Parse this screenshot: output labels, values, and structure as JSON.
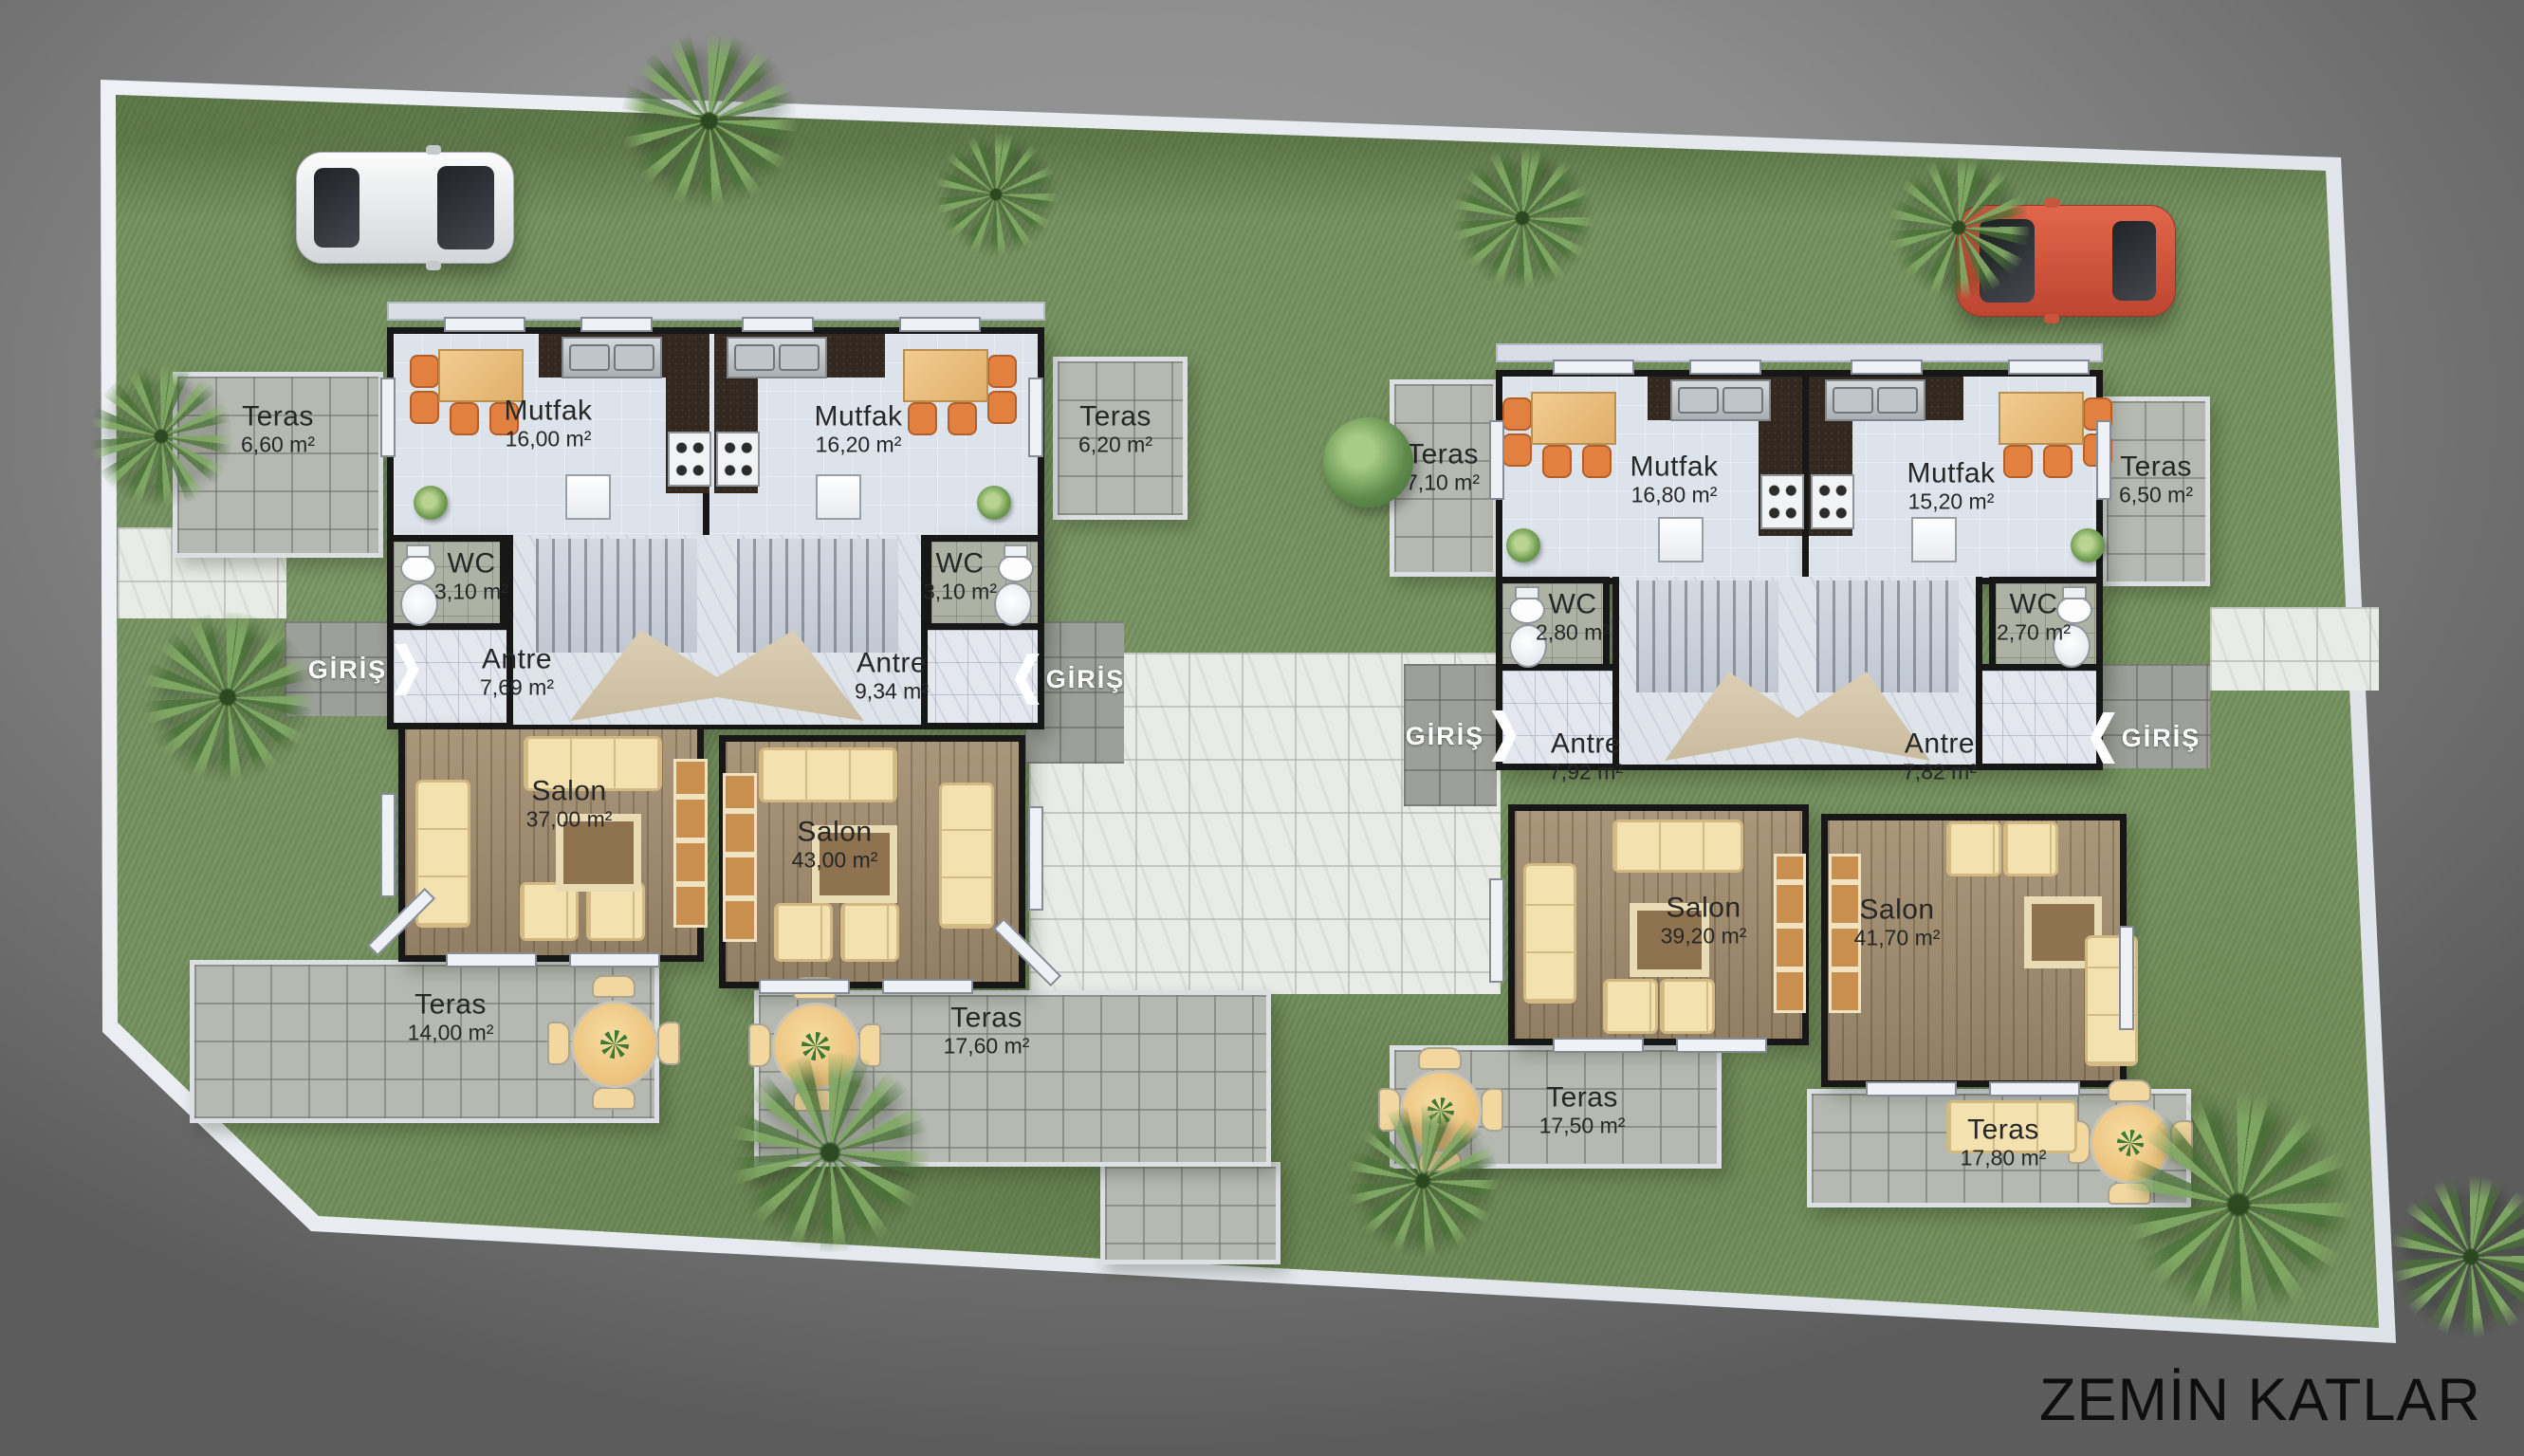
{
  "title": "ZEMİN KATLAR",
  "giris_label": "GİRİŞ",
  "colors": {
    "background_gray": "#8d8d8d",
    "grass": "#74905d",
    "site_border": "#e7eaef",
    "wall": "#171717",
    "terrace_tile": "#b6b9b2",
    "plaza_tile": "#e9ece6",
    "kitchen_floor": "#dde3eb",
    "salon_wood": "#a38e6f",
    "sofa_cream": "#f3e2b0",
    "chair_orange": "#e2813f",
    "car_white": "#f0f0f0",
    "car_red": "#d05540",
    "title_color": "#0e0e0e"
  },
  "b0": {
    "u0": {
      "teras_top": {
        "name": "Teras",
        "area": "6,60 m²"
      },
      "mutfak": {
        "name": "Mutfak",
        "area": "16,00 m²"
      },
      "wc": {
        "name": "WC",
        "area": "3,10 m²"
      },
      "antre": {
        "name": "Antre",
        "area": "7,69 m²"
      },
      "salon": {
        "name": "Salon",
        "area": "37,00 m²"
      },
      "teras_bottom": {
        "name": "Teras",
        "area": "14,00 m²"
      }
    },
    "u1": {
      "teras_top": {
        "name": "Teras",
        "area": "6,20 m²"
      },
      "mutfak": {
        "name": "Mutfak",
        "area": "16,20 m²"
      },
      "wc": {
        "name": "WC",
        "area": "3,10 m²"
      },
      "antre": {
        "name": "Antre",
        "area": "9,34 m²"
      },
      "salon": {
        "name": "Salon",
        "area": "43,00 m²"
      },
      "teras_bottom": {
        "name": "Teras",
        "area": "17,60 m²"
      }
    }
  },
  "b1": {
    "u0": {
      "teras_top": {
        "name": "Teras",
        "area": "7,10 m²"
      },
      "mutfak": {
        "name": "Mutfak",
        "area": "16,80 m²"
      },
      "wc": {
        "name": "WC",
        "area": "2,80 m²"
      },
      "antre": {
        "name": "Antre",
        "area": "7,92 m²"
      },
      "salon": {
        "name": "Salon",
        "area": "39,20 m²"
      },
      "teras_bottom": {
        "name": "Teras",
        "area": "17,50 m²"
      }
    },
    "u1": {
      "teras_top": {
        "name": "Teras",
        "area": "6,50 m²"
      },
      "mutfak": {
        "name": "Mutfak",
        "area": "15,20 m²"
      },
      "wc": {
        "name": "WC",
        "area": "2,70 m²"
      },
      "antre": {
        "name": "Antre",
        "area": "7,82 m²"
      },
      "salon": {
        "name": "Salon",
        "area": "41,70 m²"
      },
      "teras_bottom": {
        "name": "Teras",
        "area": "17,80 m²"
      }
    }
  }
}
